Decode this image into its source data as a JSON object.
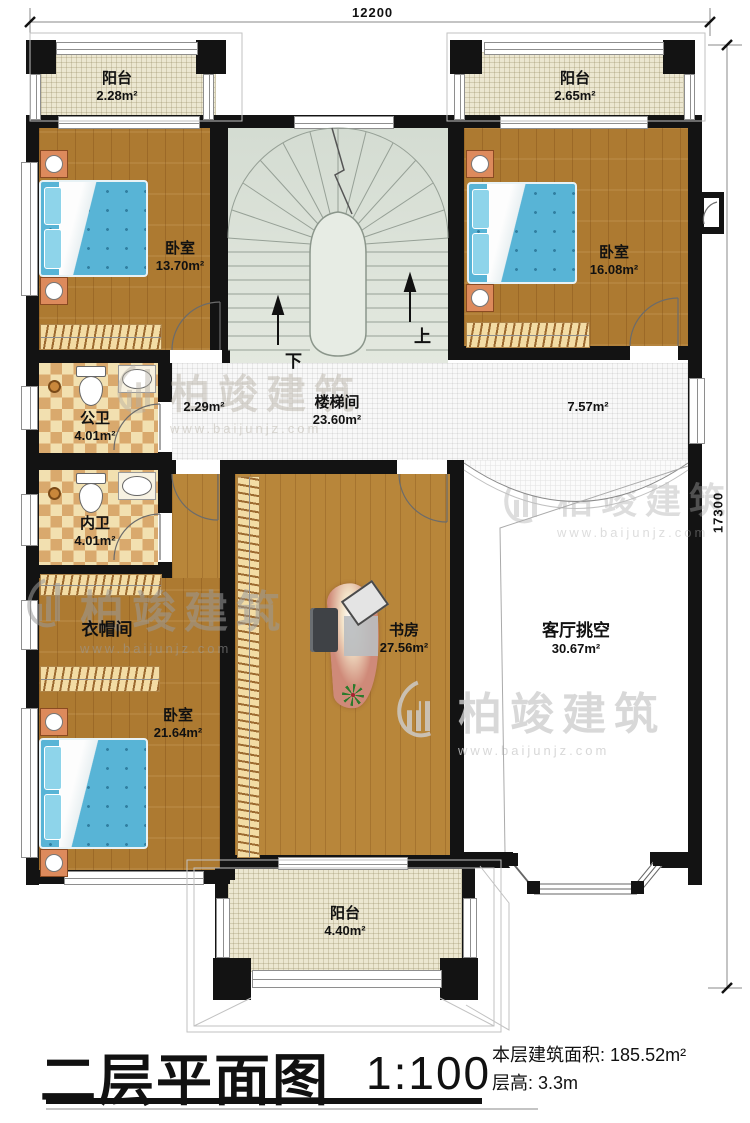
{
  "dimensions": {
    "top": "12200",
    "right": "17300"
  },
  "stairs": {
    "up": "上",
    "down": "下"
  },
  "rooms": {
    "balcony_tl": {
      "name": "阳台",
      "area": "2.28m²"
    },
    "balcony_tr": {
      "name": "阳台",
      "area": "2.65m²"
    },
    "bedroom_tl": {
      "name": "卧室",
      "area": "13.70m²"
    },
    "bedroom_tr": {
      "name": "卧室",
      "area": "16.08m²"
    },
    "stairwell": {
      "name": "楼梯间",
      "area": "23.60m²"
    },
    "hall_left": {
      "area": "2.29m²"
    },
    "hall_right": {
      "area": "7.57m²"
    },
    "bath_public": {
      "name": "公卫",
      "area": "4.01m²"
    },
    "bath_private": {
      "name": "内卫",
      "area": "4.01m²"
    },
    "cloakroom": {
      "name": "衣帽间"
    },
    "bedroom_bl": {
      "name": "卧室",
      "area": "21.64m²"
    },
    "study": {
      "name": "书房",
      "area": "27.56m²"
    },
    "living_void": {
      "name": "客厅挑空",
      "area": "30.67m²"
    },
    "balcony_bottom": {
      "name": "阳台",
      "area": "4.40m²"
    }
  },
  "title_block": {
    "title": "二层平面图",
    "scale": "1:100",
    "area_label": "本层建筑面积:",
    "area_value": "185.52m²",
    "height_label": "层高:",
    "height_value": "3.3m"
  },
  "watermark": {
    "brand": "柏竣建筑",
    "url": "www.baijunjz.com"
  },
  "colors": {
    "wall": "#131313",
    "wood": "#ad7a31",
    "tile_light": "#f2e0b0",
    "tile_dark": "#d9a96d",
    "stair": "#dce2d8",
    "balcony": "#ece7d1",
    "bed": "#58b4d6"
  }
}
